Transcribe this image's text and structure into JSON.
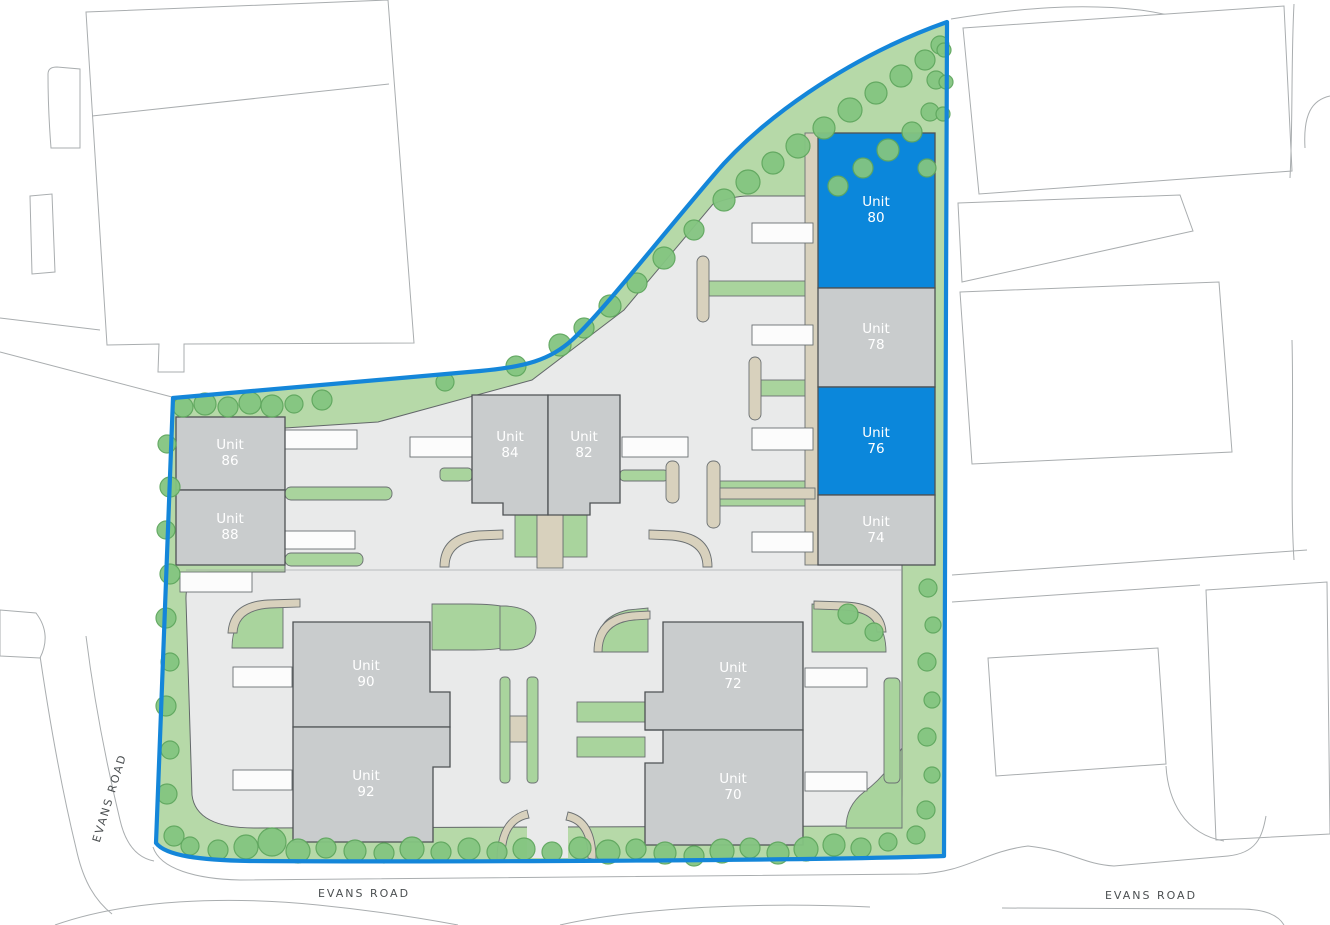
{
  "plan": {
    "unit_label_prefix": "Unit",
    "units": [
      {
        "id": "80",
        "number": "80",
        "status": "highlighted",
        "color": "#0b87db"
      },
      {
        "id": "78",
        "number": "78",
        "status": "standard",
        "color": "#c9cccd"
      },
      {
        "id": "76",
        "number": "76",
        "status": "highlighted",
        "color": "#0b87db"
      },
      {
        "id": "74",
        "number": "74",
        "status": "standard",
        "color": "#c9cccd"
      },
      {
        "id": "86",
        "number": "86",
        "status": "standard",
        "color": "#c9cccd"
      },
      {
        "id": "88",
        "number": "88",
        "status": "standard",
        "color": "#c9cccd"
      },
      {
        "id": "84",
        "number": "84",
        "status": "standard",
        "color": "#c9cccd"
      },
      {
        "id": "82",
        "number": "82",
        "status": "standard",
        "color": "#c9cccd"
      },
      {
        "id": "90",
        "number": "90",
        "status": "standard",
        "color": "#c9cccd"
      },
      {
        "id": "92",
        "number": "92",
        "status": "standard",
        "color": "#c9cccd"
      },
      {
        "id": "72",
        "number": "72",
        "status": "standard",
        "color": "#c9cccd"
      },
      {
        "id": "70",
        "number": "70",
        "status": "standard",
        "color": "#c9cccd"
      }
    ],
    "roads": {
      "west": "EVANS ROAD",
      "south": "EVANS ROAD",
      "southeast": "EVANS ROAD"
    },
    "colors": {
      "boundary": "#1486d9",
      "unit_highlight": "#0b87db",
      "unit_standard": "#c9cccd",
      "landscape": "#b6d9a8",
      "tree": "#84c581",
      "paving": "#e9eaea",
      "path": "#d8d1bd",
      "unit_label": "#ffffff",
      "road_label": "#4b4f51"
    }
  }
}
